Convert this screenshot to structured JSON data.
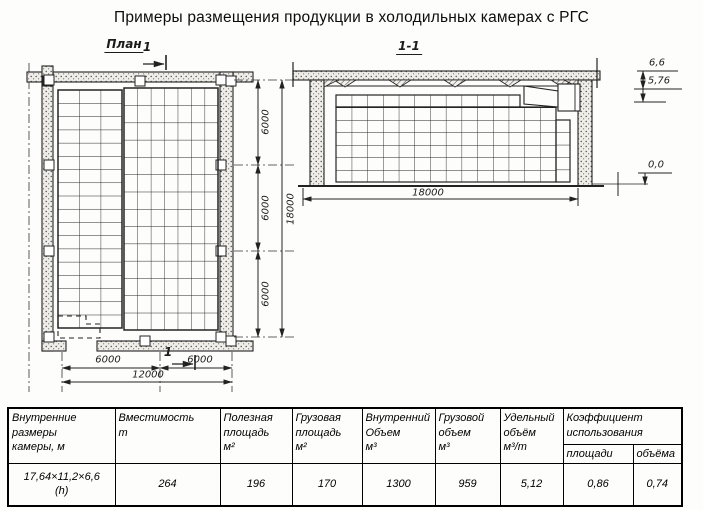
{
  "title": "Примеры размещения продукции в холодильных камерах с РГС",
  "plan": {
    "label": "План",
    "cut_mark_top": "1",
    "cut_mark_bottom": "1",
    "dim_right": [
      "6000",
      "6000",
      "6000"
    ],
    "dim_right_total": "18000",
    "dim_bottom": [
      "6000",
      "6000"
    ],
    "dim_bottom_total": "12000"
  },
  "section": {
    "label": "1-1",
    "elev_top": "6,6",
    "elev_ceiling": "5,76",
    "elev_floor": "0,0",
    "dim_width": "18000"
  },
  "table": {
    "headers": [
      "Внутренние\nразмеры\nкамеры, м",
      "Вместимость\nт",
      "Полезная\nплощадь\nм²",
      "Грузовая\nплощадь\nм²",
      "Внутренний\nОбъем\nм³",
      "Грузовой\nобъем\nм³",
      "Удельный\nобъём\nм³/т",
      "Коэффициент\nиспользования"
    ],
    "subheaders": [
      "площади",
      "объёма"
    ],
    "row": [
      "17,64×11,2×6,6\n(h)",
      "264",
      "196",
      "170",
      "1300",
      "959",
      "5,12",
      "0,86",
      "0,74"
    ]
  }
}
